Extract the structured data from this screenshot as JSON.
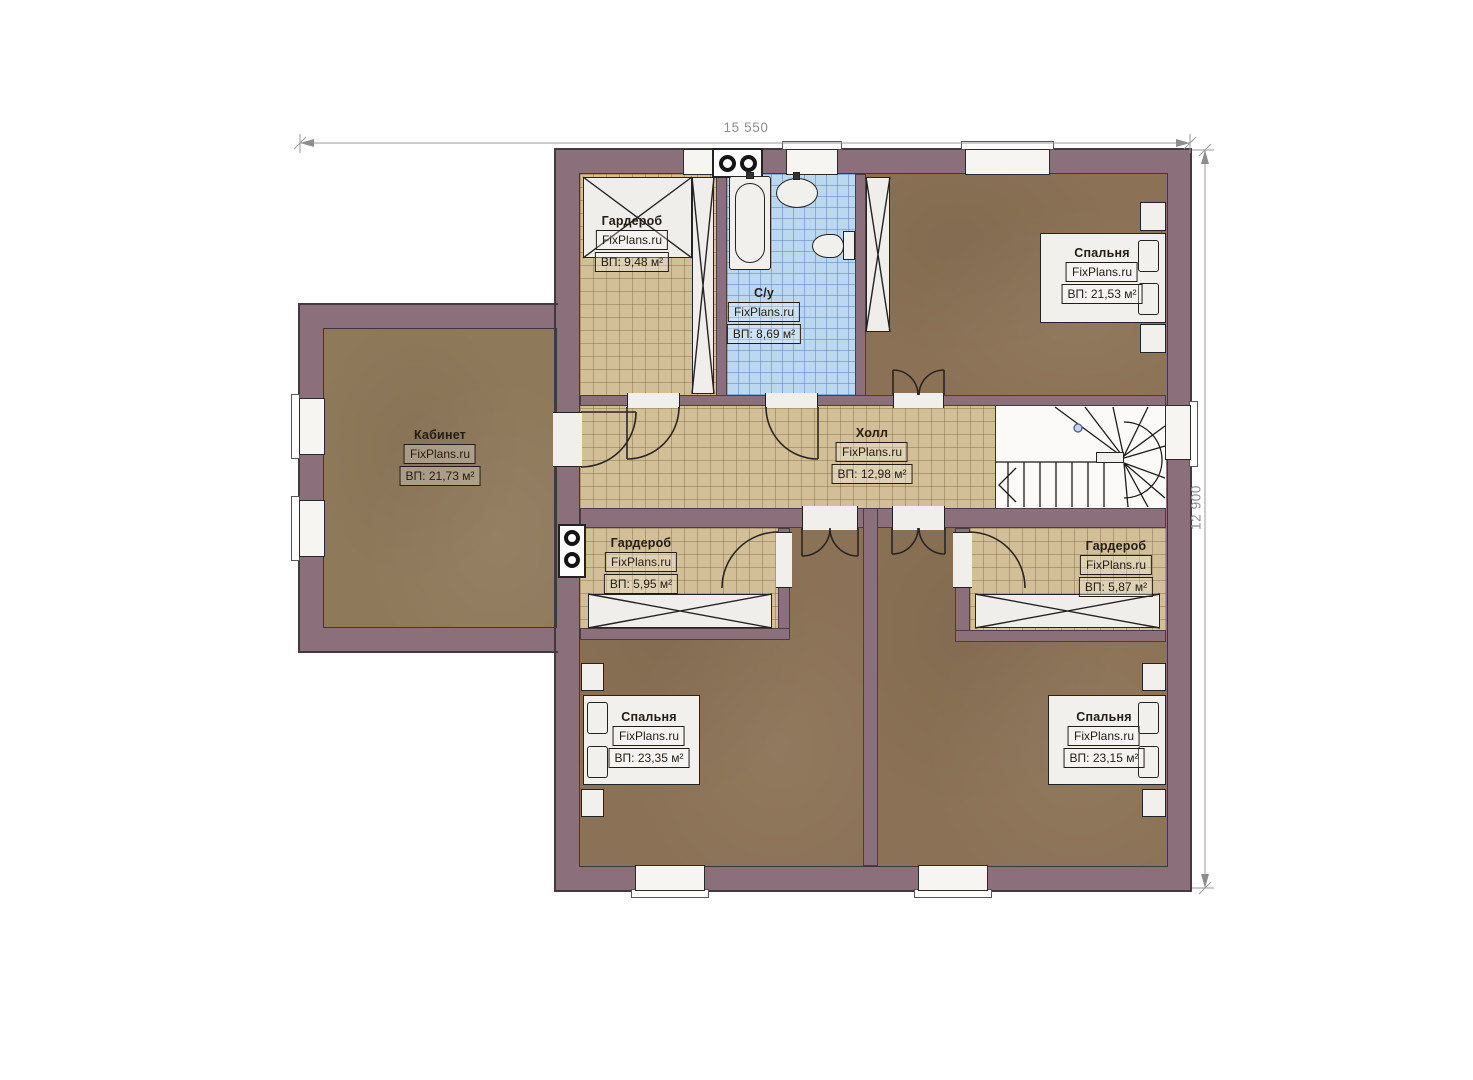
{
  "watermark": "FixPlans.ru",
  "dimensions": {
    "width": "15 550",
    "height": "12 900"
  },
  "rooms": {
    "wardrobe_top": {
      "name": "Гардероб",
      "area": "ВП: 9,48 м²"
    },
    "bathroom": {
      "name": "С/у",
      "area": "ВП: 8,69 м²"
    },
    "bedroom_top_right": {
      "name": "Спальня",
      "area": "ВП: 21,53 м²"
    },
    "office": {
      "name": "Кабинет",
      "area": "ВП: 21,73 м²"
    },
    "hall": {
      "name": "Холл",
      "area": "ВП: 12,98 м²"
    },
    "wardrobe_left": {
      "name": "Гардероб",
      "area": "ВП: 5,95 м²"
    },
    "wardrobe_right": {
      "name": "Гардероб",
      "area": "ВП: 5,87 м²"
    },
    "bedroom_bottom_left": {
      "name": "Спальня",
      "area": "ВП: 23,35 м²"
    },
    "bedroom_bottom_right": {
      "name": "Спальня",
      "area": "ВП: 23,15 м²"
    }
  },
  "colors": {
    "wall": "#8b707c",
    "bedroom_floor": "#8b7256",
    "hall_tile": "#d3bf97",
    "bath_tile": "#bcd7f0",
    "outline": "#443940"
  }
}
